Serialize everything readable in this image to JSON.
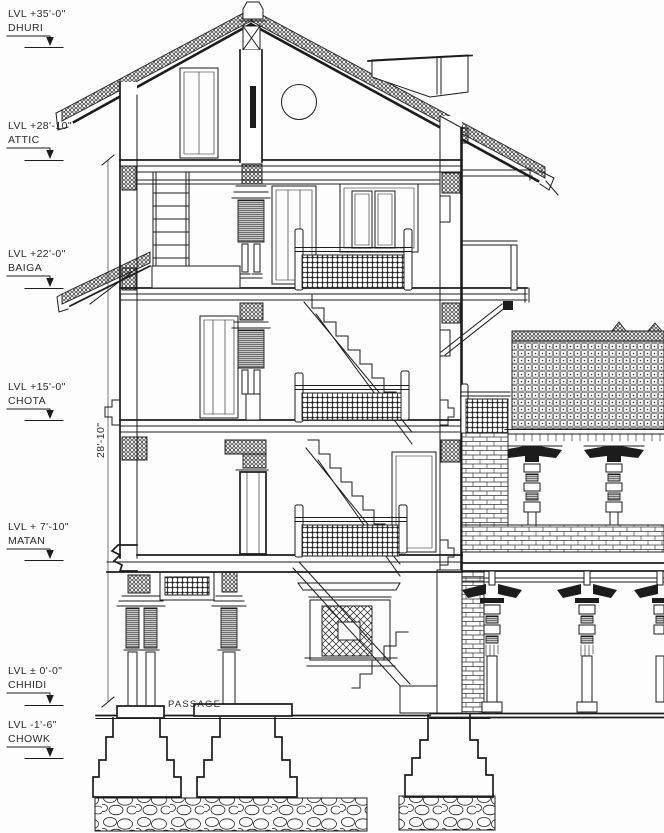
{
  "drawing": {
    "type": "architectural-section",
    "levels": [
      {
        "elevation": "LVL +35'-0\"",
        "name": "DHURI"
      },
      {
        "elevation": "LVL +28'-10\"",
        "name": "ATTIC"
      },
      {
        "elevation": "LVL +22'-0\"",
        "name": "BAIGA"
      },
      {
        "elevation": "LVL +15'-0\"",
        "name": "CHOTA"
      },
      {
        "elevation": "LVL + 7'-10\"",
        "name": "MATAN"
      },
      {
        "elevation": "LVL ± 0'-0\"",
        "name": "CHHIDI"
      },
      {
        "elevation": "LVL -1'-6\"",
        "name": "CHOWK"
      }
    ],
    "dimension": {
      "label": "28'-10\""
    },
    "room_labels": {
      "passage": "PASSAGE"
    },
    "colors": {
      "ink": "#1c1c1c",
      "paper": "#ffffff"
    }
  }
}
